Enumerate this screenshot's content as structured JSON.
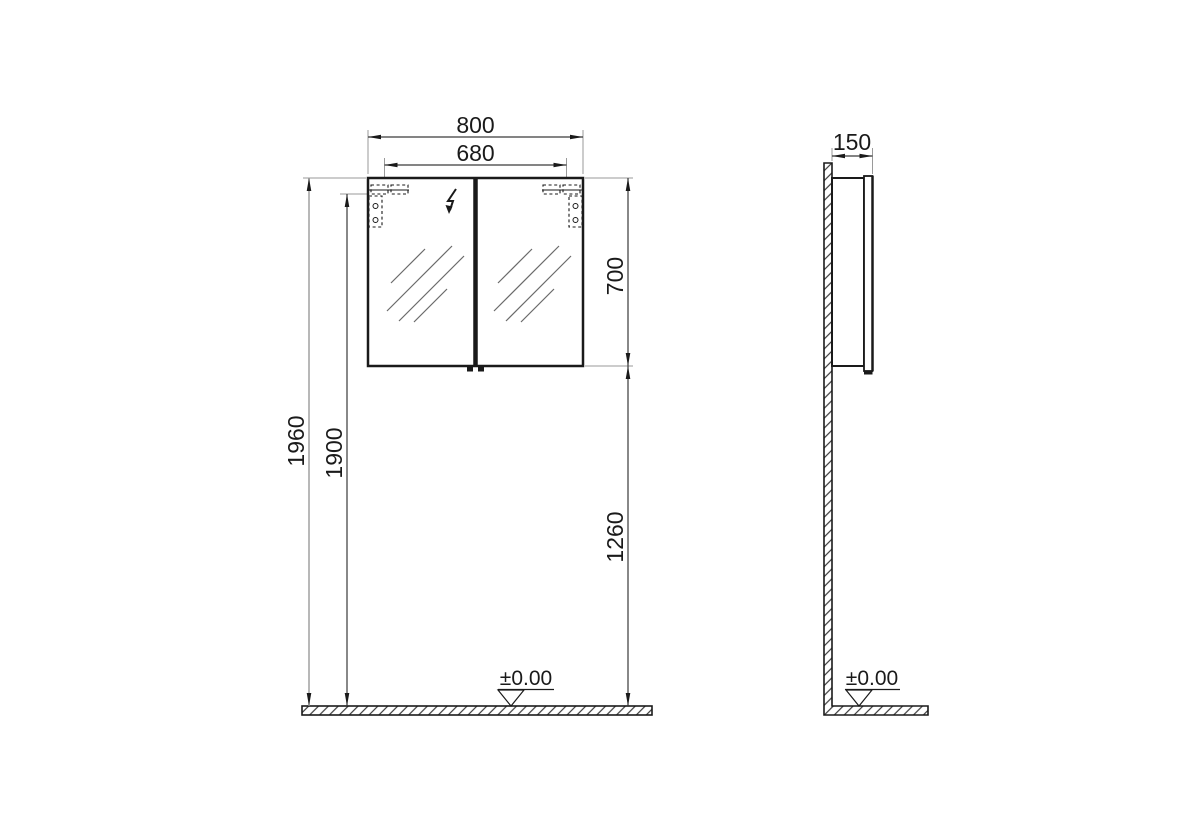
{
  "front_view": {
    "dim_width_outer": "800",
    "dim_width_inner": "680",
    "dim_cabinet_height": "700",
    "dim_overall_height": "1960",
    "dim_mounting_height": "1900",
    "dim_floor_to_cabinet": "1260",
    "floor_level": "±0.00"
  },
  "side_view": {
    "dim_depth": "150",
    "floor_level": "±0.00"
  },
  "icons": {
    "electrical_symbol": "lightning-bolt-icon"
  },
  "colors": {
    "outline": "#1a1a1a",
    "dimension_line": "#3a3a3a",
    "extension_line": "#9a9a9a",
    "background": "#ffffff"
  }
}
